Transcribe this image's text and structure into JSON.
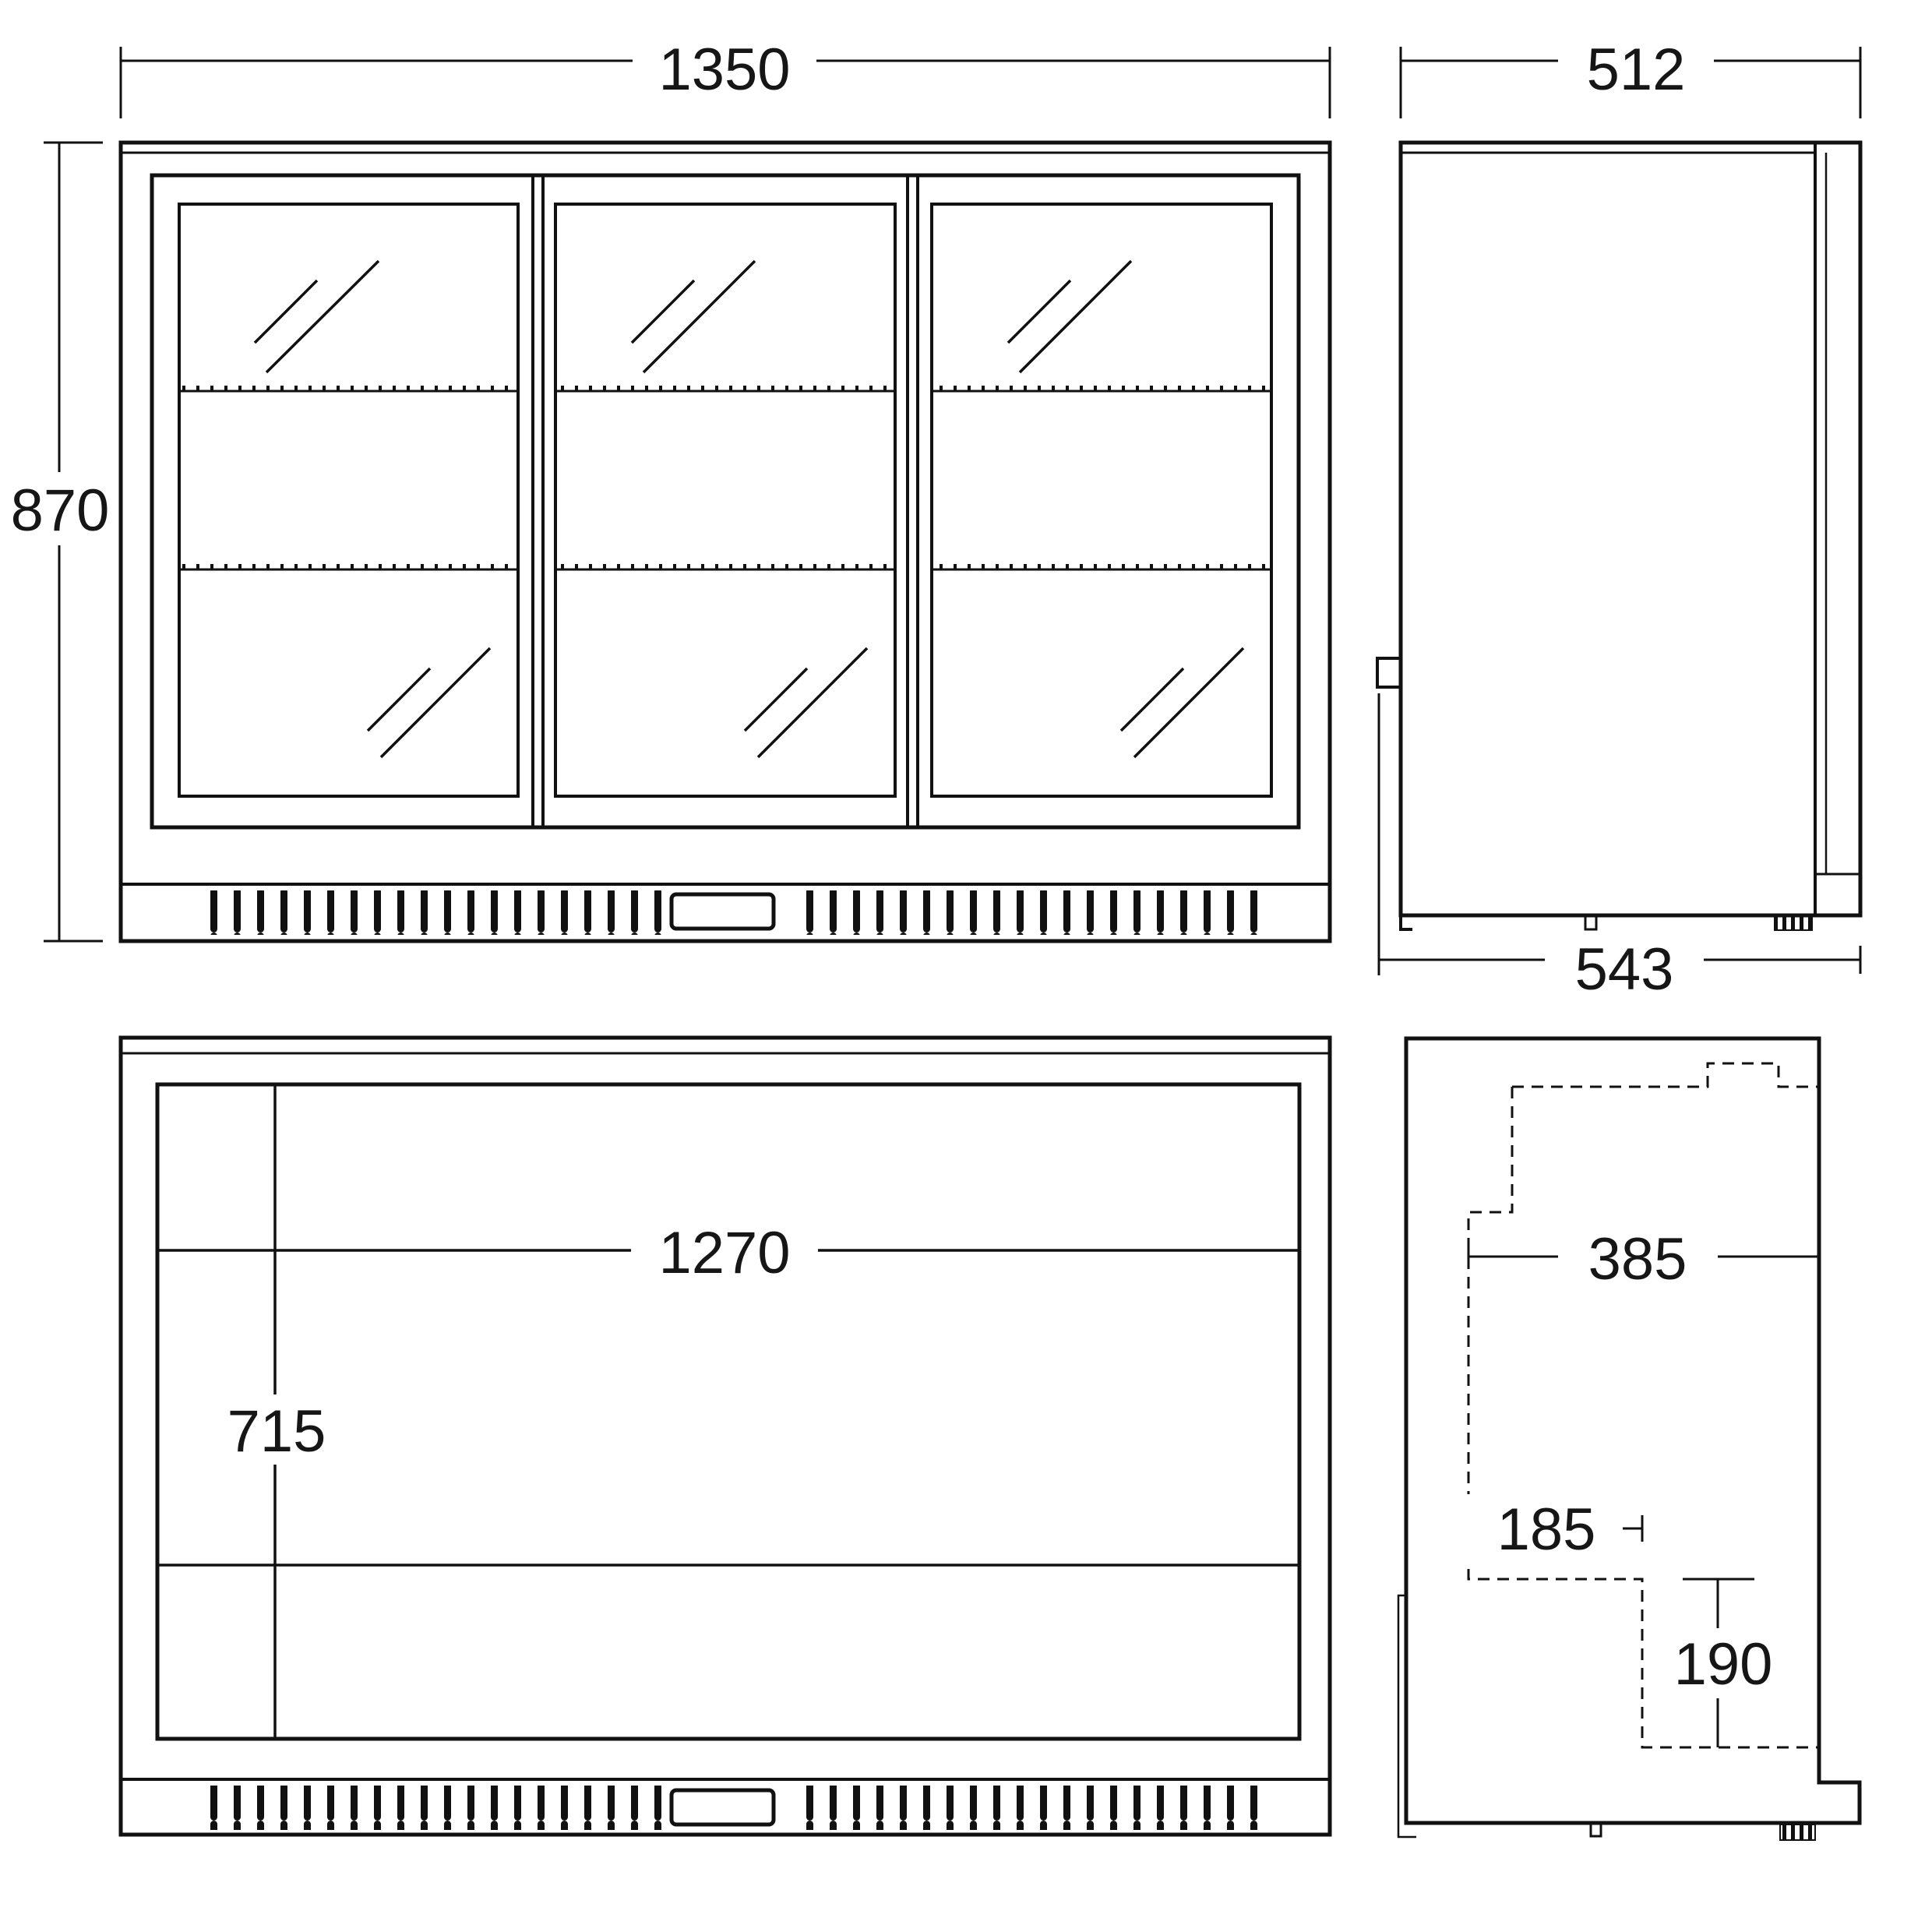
{
  "drawing": {
    "title": "refrigerated back bar cooler technical drawing",
    "colors": {
      "line": "#111111",
      "background": "#ffffff"
    },
    "views": {
      "front_elevation": {
        "width": "1350",
        "height": "870"
      },
      "side_elevation": {
        "depth": "512",
        "overall_depth": "543"
      },
      "internal_front": {
        "internal_width": "1270",
        "internal_height": "715"
      },
      "internal_side": {
        "internal_depth": "385",
        "recess_depth": "185",
        "recess_height": "190"
      }
    }
  }
}
